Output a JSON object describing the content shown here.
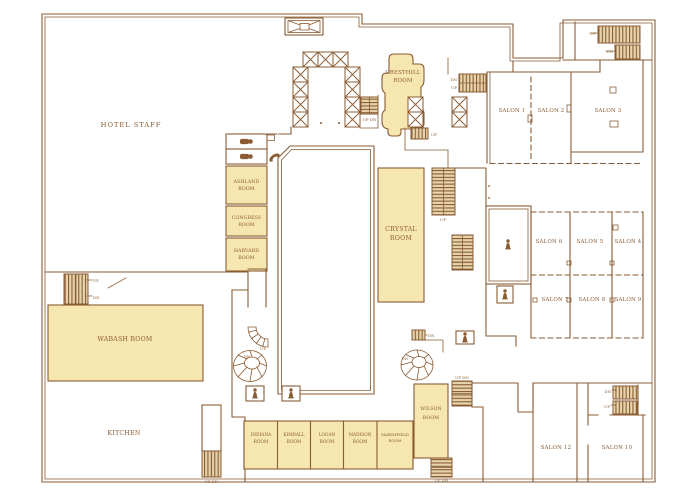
{
  "colors": {
    "ink": "#8a5c34",
    "room_fill": "#f6e6b0",
    "hatch_fill": "#e6d4ac",
    "bg": "#ffffff"
  },
  "rooms": {
    "hotel_staff": {
      "label": "HOTEL STAFF"
    },
    "cresthill": {
      "l1": "CRESTHILL",
      "l2": "ROOM"
    },
    "crystal": {
      "l1": "CRYSTAL",
      "l2": "ROOM"
    },
    "ashland": {
      "l1": "ASHLAND",
      "l2": "ROOM"
    },
    "congress": {
      "l1": "CONGRESS",
      "l2": "ROOM"
    },
    "harvard": {
      "l1": "HARVARD",
      "l2": "ROOM"
    },
    "wabash": {
      "label": "WABASH ROOM"
    },
    "kitchen": {
      "label": "KITCHEN"
    },
    "indiana": {
      "l1": "INDIANA",
      "l2": "ROOM"
    },
    "kimball": {
      "l1": "KIMBALL",
      "l2": "ROOM"
    },
    "logan": {
      "l1": "LOGAN",
      "l2": "ROOM"
    },
    "madison": {
      "l1": "MADISON",
      "l2": "ROOM"
    },
    "marshfield": {
      "l1": "MARSHFIELD",
      "l2": "ROOM"
    },
    "wilson": {
      "l1": "WILSON",
      "l2": "ROOM"
    },
    "salon1": {
      "label": "SALON 1"
    },
    "salon2": {
      "label": "SALON 2"
    },
    "salon3": {
      "label": "SALON 3"
    },
    "salon4": {
      "label": "SALON 4"
    },
    "salon5": {
      "label": "SALON 5"
    },
    "salon6": {
      "label": "SALON 6"
    },
    "salon7": {
      "label": "SALON 7"
    },
    "salon8": {
      "label": "SALON 8"
    },
    "salon9": {
      "label": "SALON 9"
    },
    "salon10": {
      "label": "SALON 10"
    },
    "salon12": {
      "label": "SALON 12"
    }
  },
  "stairs": {
    "up": "UP",
    "dn": "DN",
    "up_dn": "UP DN"
  },
  "icons": {
    "elevator_cab": "x-box-square",
    "freight_elevator": "bowtie-box",
    "staircase": "hatched-treads",
    "escalator": "hatched-treads",
    "spiral_staircase": "radial-fan",
    "statue": "person-figure",
    "restroom": "person-figure",
    "telephone": "handset"
  }
}
